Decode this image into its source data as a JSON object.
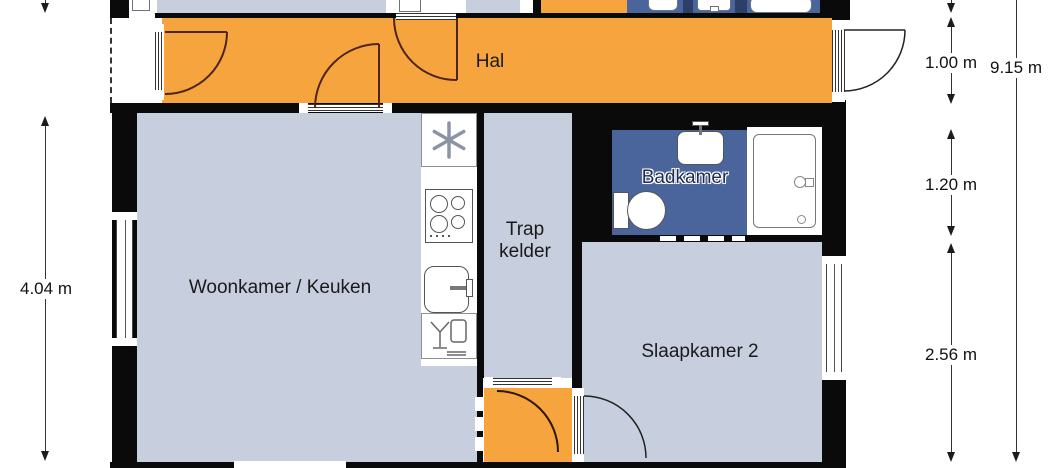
{
  "rooms": {
    "hal": "Hal",
    "woonkamer": "Woonkamer / Keuken",
    "trap_kelder": "Trap kelder",
    "badkamer": "Badkamer",
    "slaapkamer2": "Slaapkamer 2"
  },
  "dimensions": {
    "living_height": "4.04 m",
    "hall_depth": "1.00 m",
    "bathroom_depth": "1.20 m",
    "bedroom_depth": "2.56 m",
    "total_height": "9.15 m"
  },
  "colors": {
    "hall_floor": "#F5A43E",
    "room_floor": "#C7CEDE",
    "bathroom_floor": "#4A659B",
    "bathroom_divider": "#2C3F66",
    "wall": "#0A0A0A",
    "door_arc": "#4F241C",
    "dimension_line": "#333333"
  },
  "icons": {
    "extractor_hood_icon": "six-arm asterisk",
    "cooktop_icon": "four burner circles",
    "kitchen_sink_icon": "rounded basin with faucet",
    "dish_rack_icon": "glass and plate",
    "washbasin_icon": "basin with tap",
    "toilet_icon": "cistern with bowl",
    "shower_icon": "tray with door handle and drain"
  }
}
